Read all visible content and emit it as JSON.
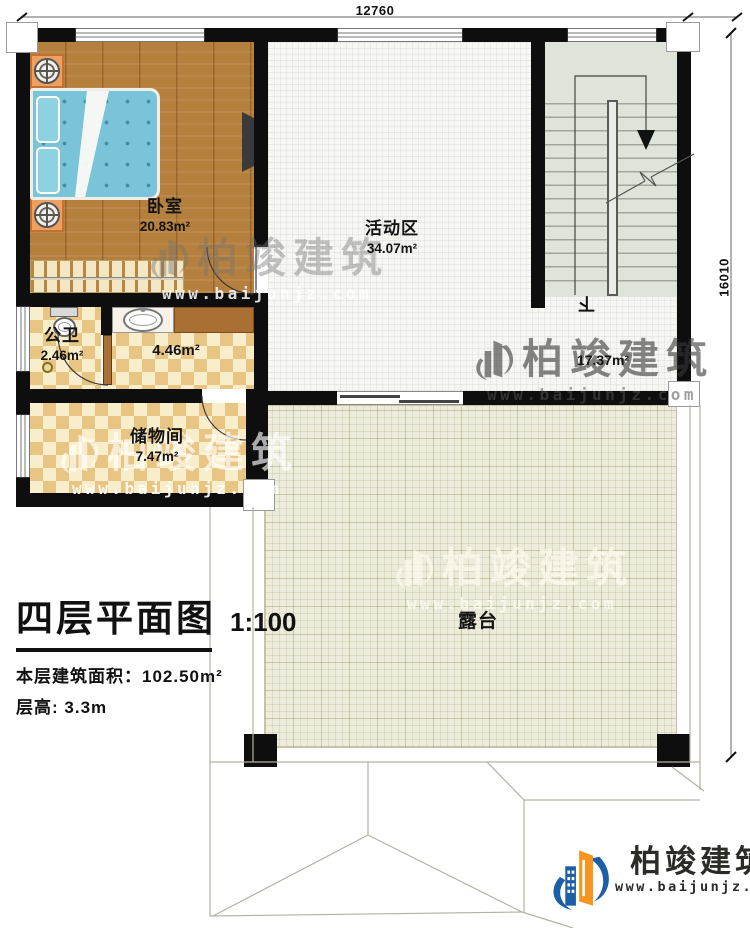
{
  "dims": {
    "top": "12760",
    "right": "16010"
  },
  "rooms": {
    "bedroom": {
      "name": "卧室",
      "area": "20.83m²"
    },
    "activity": {
      "name": "活动区",
      "area": "34.07m²"
    },
    "bathroom": {
      "name": "公卫",
      "area": "2.46m²"
    },
    "hallway": {
      "area": "4.46m²"
    },
    "storage": {
      "name": "储物间",
      "area": "7.47m²"
    },
    "stair_hall": {
      "area": "17.37m²"
    },
    "terrace": {
      "name": "露台"
    },
    "stairs": {
      "direction": "下"
    }
  },
  "title": {
    "heading": "四层平面图",
    "scale": "1:100",
    "area_label": "本层建筑面积：",
    "area_value": "102.50m²",
    "height_label": "层高:",
    "height_value": "3.3m"
  },
  "watermark": {
    "brand": "柏竣建筑",
    "url": "www.baijunjz.com"
  },
  "logo": {
    "brand": "柏竣建筑",
    "url": "www.baijunjz.com"
  },
  "palette": {
    "wall": "#0e0e0e",
    "wood_floor": "#b5803d",
    "tile_checker": "#e9c583",
    "terrace": "#edebdb",
    "stairs": "#dfe4da",
    "bed_blue": "#79c4d8",
    "logo_blue": "#1c5fa8",
    "logo_orange": "#f7941d"
  }
}
